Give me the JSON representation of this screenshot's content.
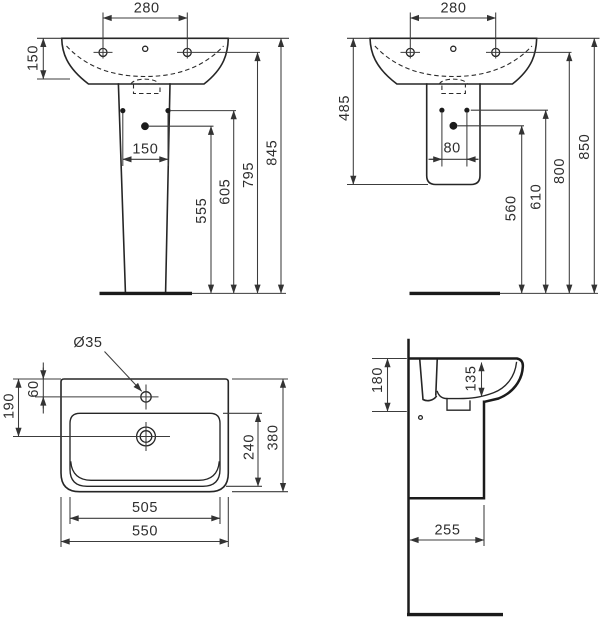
{
  "views": {
    "front_pedestal": {
      "name": "front view with full pedestal",
      "dims": {
        "tap_spacing": "280",
        "rim_height": "150",
        "fixing_spacing": "150",
        "drain_height": "555",
        "fixing_holes_height": "605",
        "tap_deck_height": "795",
        "overall_height": "845"
      }
    },
    "wall_hung": {
      "name": "front view with semi pedestal",
      "dims": {
        "tap_spacing": "280",
        "body_height": "485",
        "fixing_spacing": "80",
        "drain_height": "560",
        "fixing_holes_height": "610",
        "tap_deck_height": "800",
        "overall_height": "850"
      }
    },
    "plan": {
      "name": "top view",
      "dims": {
        "tap_hole_diameter": "Ø35",
        "tap_hole_offset": "60",
        "drain_offset": "190",
        "bowl_depth": "240",
        "overall_depth": "380",
        "bowl_width": "505",
        "overall_width": "550"
      }
    },
    "section": {
      "name": "side section view",
      "dims": {
        "front_height": "180",
        "bowl_inner_depth": "135",
        "wall_projection": "255"
      }
    }
  }
}
